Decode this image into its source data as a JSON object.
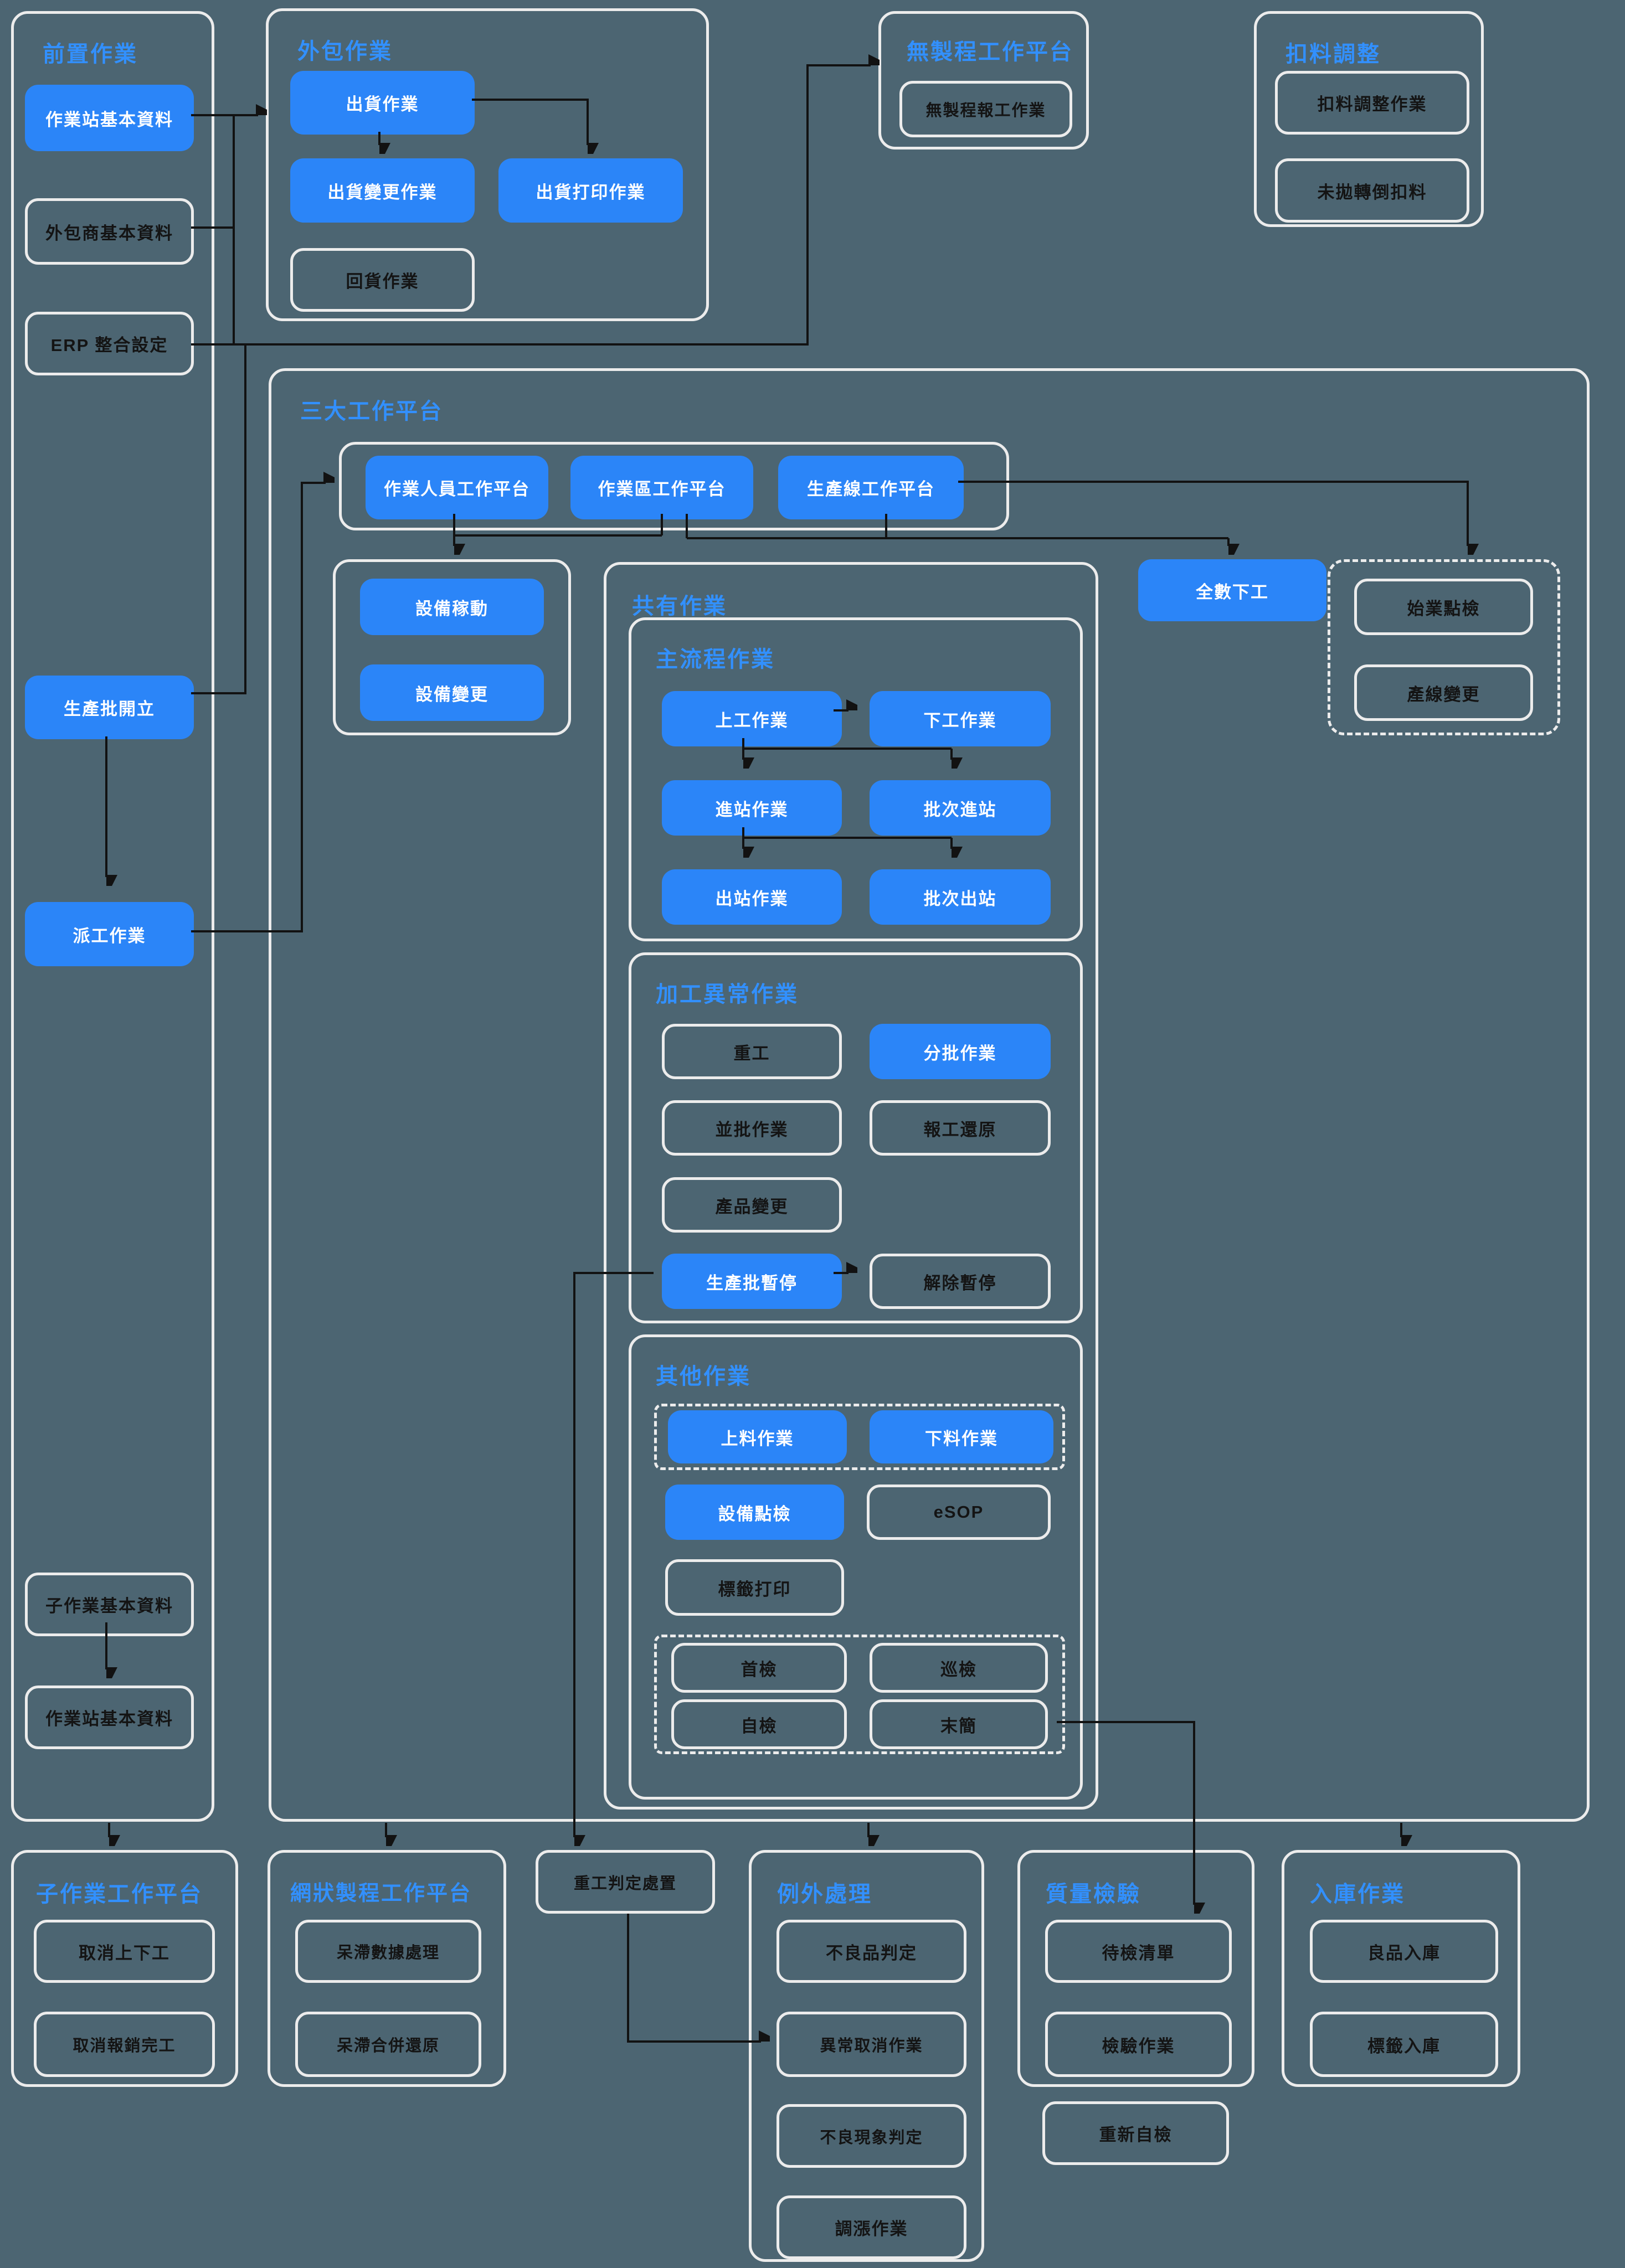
{
  "palette": {
    "background": "#4C6572",
    "node_blue": "#2B85F8",
    "header_blue": "#3290FF",
    "border_gray": "#ECECEC",
    "text_dark": "#141414",
    "text_light": "#FFFFFF",
    "connector_black": "#121212"
  },
  "groups": {
    "pre": "前置作業",
    "outsourcing": "外包作業",
    "noproc": "無製程工作平台",
    "deduct": "扣料調整",
    "big3": "三大工作平台",
    "shared": "共有作業",
    "mainflow": "主流程作業",
    "abnormal": "加工異常作業",
    "other": "其他作業",
    "subop": "子作業工作平台",
    "mesh": "網狀製程工作平台",
    "exception": "例外處理",
    "qc": "質量檢驗",
    "warehouse": "入庫作業"
  },
  "nodes": {
    "ws_basic_top": "作業站基本資料",
    "vendor_basic": "外包商基本資料",
    "erp_integration": "ERP 整合設定",
    "batch_create": "生產批開立",
    "dispatch": "派工作業",
    "sub_op_basic": "子作業基本資料",
    "ws_basic_bottom": "作業站基本資料",
    "ship": "出貨作業",
    "ship_change": "出貨變更作業",
    "ship_print": "出貨打印作業",
    "ship_return": "回貨作業",
    "noproc_report": "無製程報工作業",
    "deduct_adjust": "扣料調整作業",
    "deduct_unposted": "未拋轉倒扣料",
    "platform_operator": "作業人員工作平台",
    "platform_area": "作業區工作平台",
    "platform_line": "生產線工作平台",
    "equip_util": "設備稼動",
    "equip_change": "設備變更",
    "all_off": "全數下工",
    "start_check": "始業點檢",
    "line_change": "產線變更",
    "on_work": "上工作業",
    "off_work": "下工作業",
    "station_in": "進站作業",
    "batch_in": "批次進站",
    "station_out": "出站作業",
    "batch_out": "批次出站",
    "rework": "重工",
    "split_batch": "分批作業",
    "merge_batch": "並批作業",
    "report_restore": "報工還原",
    "product_change": "產品變更",
    "batch_pause": "生產批暫停",
    "pause_release": "解除暫停",
    "material_load": "上料作業",
    "material_unload": "下料作業",
    "equip_check": "設備點檢",
    "esop": "eSOP",
    "label_print": "標籤打印",
    "first_inspect": "首檢",
    "patrol_inspect": "巡檢",
    "self_inspect": "自檢",
    "last_inspect": "末簡",
    "cancel_onoff": "取消上下工",
    "cancel_report": "取消報銷完工",
    "stagnant_data": "呆滯數據處理",
    "stagnant_merge": "呆滯合併還原",
    "rework_judge": "重工判定處置",
    "defect_judge": "不良品判定",
    "abnormal_cancel": "異常取消作業",
    "defect_phenomenon": "不良現象判定",
    "adjust_op": "調漲作業",
    "pending_list": "待檢清單",
    "inspect_op": "檢驗作業",
    "re_self_check": "重新自檢",
    "good_in": "良品入庫",
    "label_in": "標籤入庫"
  }
}
